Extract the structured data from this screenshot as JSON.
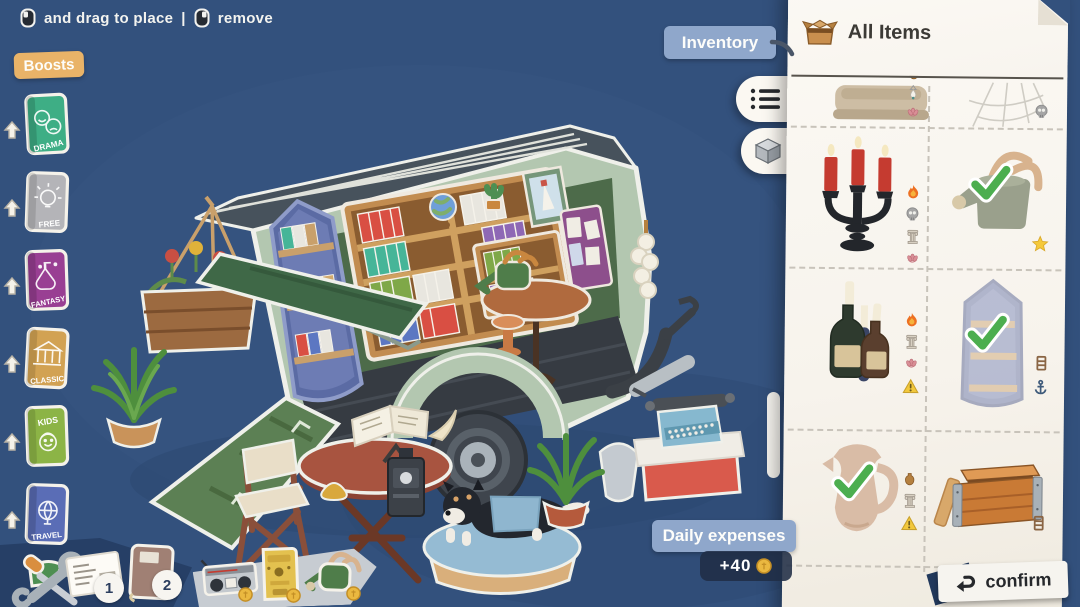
{
  "colors": {
    "background": "#33517d",
    "panel": "#faf7f1",
    "badge_blue": "#8fa7cb",
    "badge_tan": "#e9b368",
    "check_green": "#4cae4f",
    "coin_gold": "#eab840",
    "ink": "#3c3a36"
  },
  "hint": {
    "left_mouse_icon": "left-click-mouse-icon",
    "drag_label": "and drag to place",
    "separator": "|",
    "right_mouse_icon": "right-click-mouse-icon",
    "remove_label": "remove"
  },
  "boosts": {
    "label": "Boosts",
    "books": [
      {
        "label": "DRAMA",
        "color": "#3eae85",
        "icon": "drama-masks-icon"
      },
      {
        "label": "FREE",
        "color": "#b4b4b8",
        "icon": "light-bulb-icon"
      },
      {
        "label": "FANTASY",
        "color": "#993f93",
        "icon": "potion-flask-icon"
      },
      {
        "label": "CLASSIC",
        "color": "#d2a253",
        "icon": "temple-icon"
      },
      {
        "label": "KIDS",
        "color": "#8cb446",
        "icon": "child-face-icon"
      },
      {
        "label": "TRAVEL",
        "color": "#5a6db6",
        "icon": "globe-icon"
      }
    ]
  },
  "scene": {
    "objects": [
      "book-trailer",
      "roof",
      "awning",
      "hanging-basket",
      "boat-bookshelf",
      "bookshelf",
      "side-shelf",
      "globe",
      "cactus",
      "picture-frame",
      "magazine-rack",
      "round-table",
      "watering-can",
      "stool",
      "garlic-string",
      "scooter",
      "trailer-wheel",
      "ramp",
      "fern-left",
      "folding-chair",
      "outdoor-table",
      "open-book",
      "quill",
      "coffee-grinder",
      "pastry",
      "dog-bed",
      "dog",
      "fern-right",
      "typewriter",
      "red-crate"
    ]
  },
  "inventory": {
    "label": "Inventory",
    "panel_title": "All Items",
    "panel_icon": "open-box-icon",
    "view_toggles": [
      {
        "icon": "list-view-icon"
      },
      {
        "icon": "cube-3d-view-icon"
      }
    ],
    "items": [
      {
        "name": "bench",
        "row": 0,
        "col": 0,
        "equipped": false,
        "badges": [
          "vase",
          "pendant-lamp",
          "lotus"
        ]
      },
      {
        "name": "spiderweb",
        "row": 0,
        "col": 1,
        "equipped": false,
        "badges": [
          "skull"
        ]
      },
      {
        "name": "candelabra",
        "row": 1,
        "col": 0,
        "equipped": false,
        "badges": [
          "flame",
          "skull",
          "column",
          "lotus"
        ]
      },
      {
        "name": "watering-can",
        "row": 1,
        "col": 1,
        "equipped": true,
        "badges": [
          "star"
        ]
      },
      {
        "name": "bottle-candles",
        "row": 2,
        "col": 0,
        "equipped": false,
        "badges": [
          "flame",
          "column",
          "lotus",
          "warning"
        ]
      },
      {
        "name": "boat-shelf",
        "row": 2,
        "col": 1,
        "equipped": true,
        "badges": [
          "shelf",
          "anchor"
        ]
      },
      {
        "name": "pitcher",
        "row": 3,
        "col": 0,
        "equipped": true,
        "badges": [
          "vase",
          "column",
          "warning"
        ]
      },
      {
        "name": "wooden-crate",
        "row": 3,
        "col": 1,
        "equipped": false,
        "badges": [
          "shelf"
        ]
      }
    ]
  },
  "daily_expenses": {
    "label": "Daily expenses",
    "amount": "+40",
    "coin_icon": "coin-icon"
  },
  "confirm": {
    "label": "confirm",
    "icon": "return-arrow-icon"
  },
  "toolbar_left": {
    "tools_icon": "repair-tools-icon",
    "letters_icon": "letter-icon",
    "letters_badge": "1",
    "journal_icon": "journal-icon",
    "journal_badge": "2"
  },
  "tray_shop": {
    "items": [
      {
        "name": "radio",
        "coin": true
      },
      {
        "name": "coffee-machine",
        "coin": true
      },
      {
        "name": "watering-can",
        "coin": true
      }
    ]
  }
}
